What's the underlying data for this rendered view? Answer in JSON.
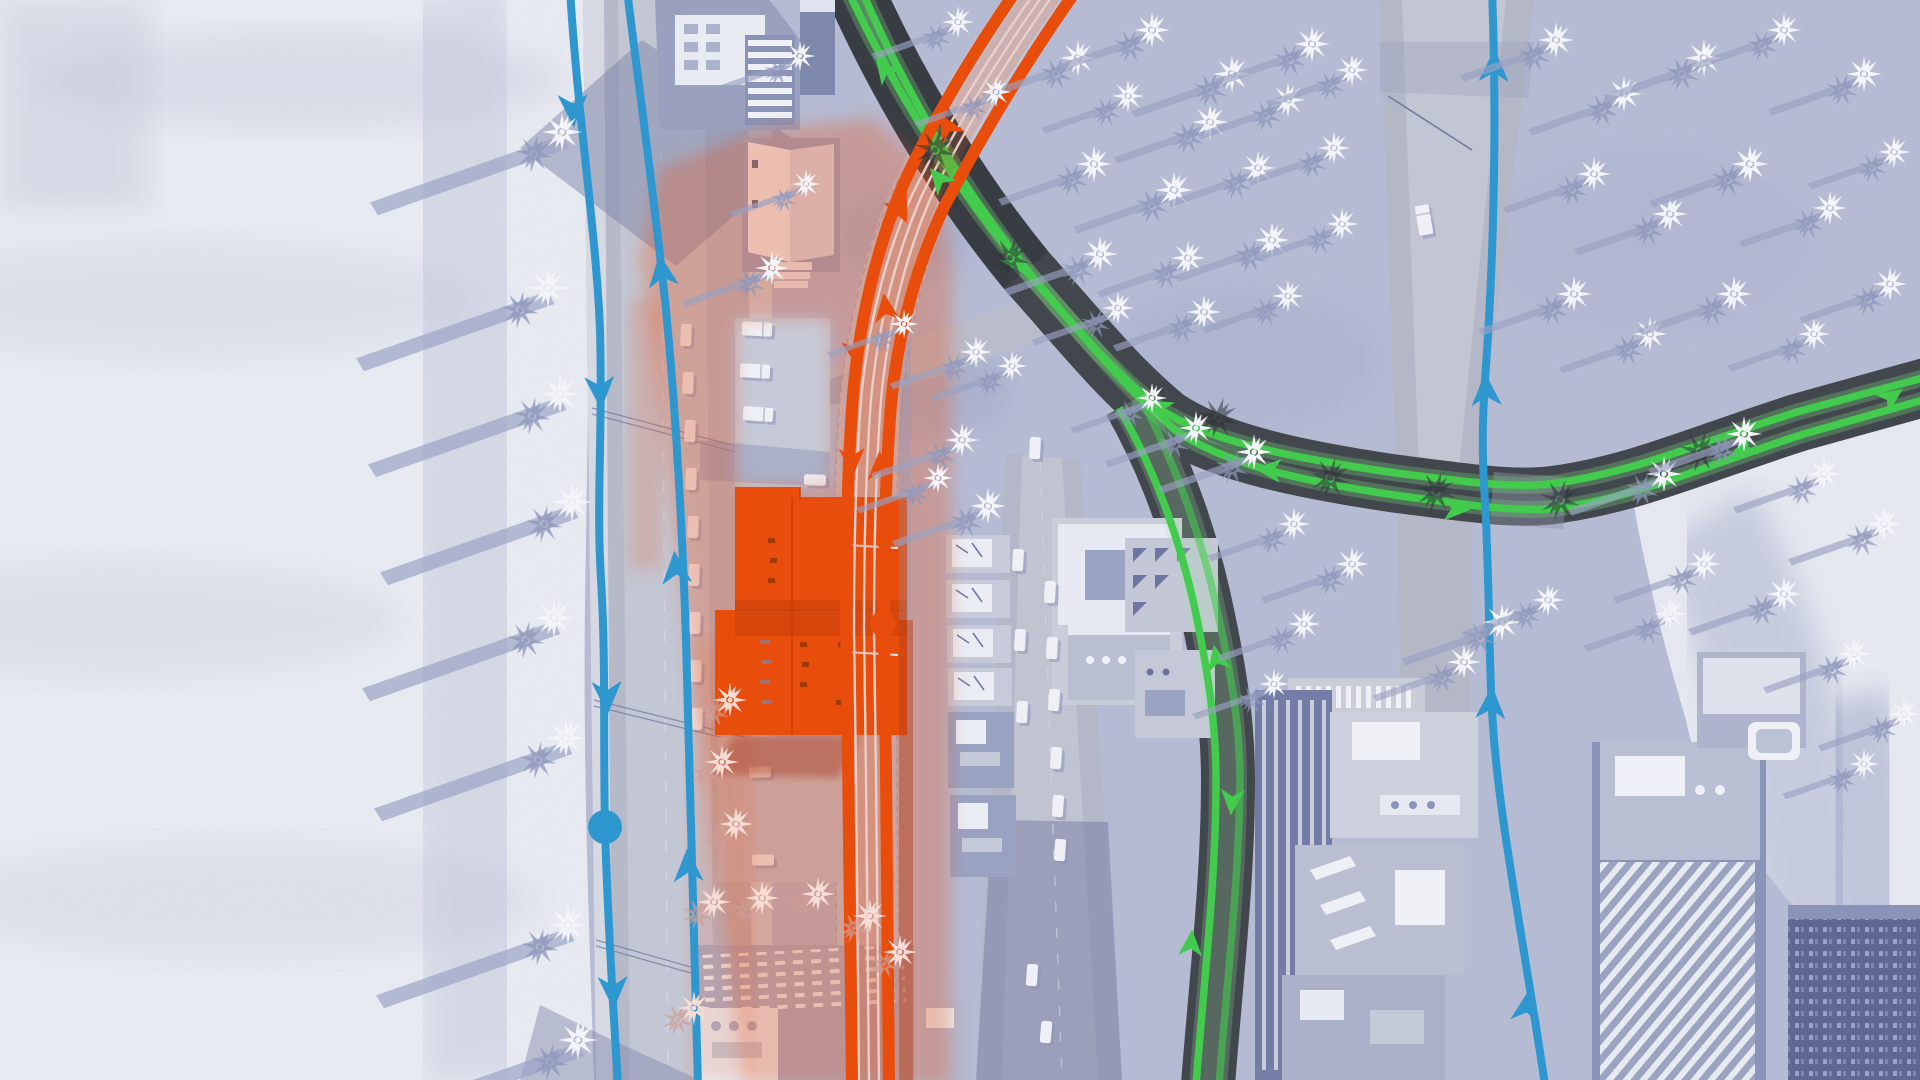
{
  "meta": {
    "app": "city-builder-game",
    "view": "public-transport-lines-overlay",
    "visible_text": "none",
    "canvas": [
      1920,
      1080
    ]
  },
  "palette": {
    "terrain": "#b5bbd3",
    "terrainShade": "#8d96bb",
    "beach": "#e9ebf2",
    "roadLight": "#b6b9c8",
    "roadLane": "#c3c6d3",
    "sidewalk": "#d3d6e1",
    "roadDark": "#42474d",
    "railBand": "#c5c8d5",
    "railWhite": "#e9ebf3",
    "wall": "#99a1bf",
    "wallDark": "#747da6",
    "roof": "#c9cdda",
    "whiteDetail": "#eff1f7",
    "blue": "#2f97d0",
    "green": "#43cb4e",
    "greenHalo": "#7ad77f",
    "orange": "#e84d0c",
    "orangeDeep": "#c2410a",
    "zoneRed": "#e85a28",
    "treeWhite": "#f3f4f8",
    "treeShadow": "#8e97bb",
    "zoneTree": "#f6dcd4",
    "zoneTreeShadow": "#cf9f96",
    "darkBldg": "#5f6890"
  },
  "overlay": {
    "routes": [
      {
        "id": "blue-line-west",
        "color": "#2f97d0",
        "direction": "southbound",
        "arrow_count": 4
      },
      {
        "id": "blue-line-east",
        "color": "#2f97d0",
        "direction": "northbound",
        "arrow_count": 3
      },
      {
        "id": "blue-line-far-east",
        "color": "#2f97d0",
        "direction": "northbound",
        "arrow_count": 4
      },
      {
        "id": "green-line",
        "color": "#43cb4e",
        "direction": "two-way",
        "shape": "curve-with-south-branch"
      },
      {
        "id": "orange-rail-line",
        "color": "#e84d0c",
        "direction": "two-way",
        "follows": "railway"
      }
    ],
    "stops": [
      {
        "id": "blue-stop",
        "x": 605,
        "y": 827,
        "r": 17,
        "color": "#2f97d0"
      },
      {
        "id": "orange-stop",
        "x": 883,
        "y": 624,
        "r": 13,
        "color": "#e84d0c"
      }
    ],
    "selected_building": {
      "id": "selected-rail-depot",
      "x": 735,
      "y": 497,
      "w": 172,
      "h": 238,
      "color": "#e84d0c"
    }
  },
  "scene": {
    "beach_trees": [
      [
        562,
        132
      ],
      [
        548,
        288
      ],
      [
        560,
        394
      ],
      [
        572,
        502
      ],
      [
        554,
        618
      ],
      [
        566,
        738
      ],
      [
        568,
        925
      ],
      [
        578,
        1040
      ]
    ],
    "east_trees": [
      [
        1078,
        58,
        1
      ],
      [
        1152,
        30,
        1
      ],
      [
        1232,
        74,
        1.05
      ],
      [
        1312,
        44,
        1
      ],
      [
        1128,
        96,
        0.9
      ],
      [
        1210,
        122,
        1
      ],
      [
        1288,
        100,
        0.95
      ],
      [
        1352,
        70,
        0.9
      ],
      [
        1094,
        164,
        1
      ],
      [
        1174,
        190,
        1.05
      ],
      [
        1258,
        168,
        0.95
      ],
      [
        1334,
        148,
        0.9
      ],
      [
        1100,
        254,
        1
      ],
      [
        1188,
        258,
        0.95
      ],
      [
        1272,
        240,
        1
      ],
      [
        1342,
        224,
        0.9
      ],
      [
        1118,
        308,
        0.9
      ],
      [
        1204,
        312,
        0.95
      ],
      [
        1288,
        296,
        0.9
      ],
      [
        1556,
        40,
        1
      ],
      [
        1624,
        94,
        1
      ],
      [
        1704,
        58,
        1.05
      ],
      [
        1784,
        30,
        0.95
      ],
      [
        1864,
        74,
        1
      ],
      [
        1594,
        174,
        0.95
      ],
      [
        1670,
        214,
        1
      ],
      [
        1750,
        164,
        1.05
      ],
      [
        1830,
        208,
        0.95
      ],
      [
        1894,
        152,
        0.9
      ],
      [
        1574,
        294,
        1
      ],
      [
        1650,
        334,
        0.95
      ],
      [
        1734,
        294,
        1
      ],
      [
        1814,
        334,
        0.9
      ],
      [
        1890,
        284,
        0.95
      ],
      [
        1196,
        428,
        0.95
      ],
      [
        1254,
        452,
        1
      ],
      [
        1152,
        398,
        0.85
      ],
      [
        1502,
        622,
        1.05
      ],
      [
        1548,
        600,
        0.9
      ],
      [
        1464,
        662,
        0.95
      ],
      [
        1294,
        524,
        0.9
      ],
      [
        1352,
        564,
        0.95
      ],
      [
        1304,
        624,
        0.9
      ],
      [
        1274,
        684,
        0.85
      ],
      [
        1664,
        474,
        1
      ],
      [
        1744,
        434,
        1
      ],
      [
        1824,
        474,
        0.95
      ],
      [
        1884,
        524,
        1
      ],
      [
        1704,
        564,
        0.95
      ],
      [
        1784,
        594,
        1
      ],
      [
        1854,
        654,
        0.95
      ],
      [
        1670,
        614,
        0.9
      ],
      [
        1904,
        714,
        0.9
      ],
      [
        1864,
        764,
        0.85
      ],
      [
        962,
        440,
        0.95
      ],
      [
        988,
        506,
        1
      ],
      [
        938,
        478,
        0.85
      ],
      [
        976,
        352,
        0.9
      ],
      [
        1012,
        366,
        0.85
      ],
      [
        772,
        268,
        0.95
      ],
      [
        806,
        184,
        0.8
      ],
      [
        800,
        56,
        0.85
      ],
      [
        958,
        22,
        0.9
      ],
      [
        996,
        92,
        0.85
      ],
      [
        904,
        324,
        0.8
      ]
    ],
    "zone_trees": [
      [
        730,
        700
      ],
      [
        722,
        762
      ],
      [
        736,
        824
      ],
      [
        714,
        902
      ],
      [
        762,
        898
      ],
      [
        818,
        894
      ],
      [
        870,
        916
      ],
      [
        900,
        952
      ],
      [
        694,
        1008
      ]
    ],
    "dark_palms": [
      [
        1218,
        418
      ],
      [
        1330,
        478
      ],
      [
        1436,
        492
      ],
      [
        1700,
        452
      ],
      [
        935,
        150
      ],
      [
        1010,
        258
      ],
      [
        1560,
        500
      ]
    ],
    "blue_arrows": [
      [
        573,
        108,
        178
      ],
      [
        600,
        390,
        177
      ],
      [
        607,
        695,
        178
      ],
      [
        613,
        990,
        178
      ],
      [
        662,
        273,
        -8
      ],
      [
        676,
        570,
        -5
      ],
      [
        688,
        868,
        -3
      ],
      [
        1494,
        68,
        2
      ],
      [
        1486,
        392,
        -3
      ],
      [
        1491,
        705,
        3
      ],
      [
        1527,
        1008,
        8
      ]
    ],
    "green_arrows": [
      [
        885,
        70,
        -37
      ],
      [
        1016,
        262,
        143
      ],
      [
        1160,
        408,
        -62
      ],
      [
        1270,
        470,
        -85
      ],
      [
        1455,
        509,
        93
      ],
      [
        1890,
        398,
        55
      ],
      [
        1745,
        448,
        -115
      ],
      [
        1217,
        660,
        -12
      ],
      [
        1191,
        945,
        4
      ],
      [
        1232,
        800,
        184
      ],
      [
        940,
        180,
        -40
      ]
    ],
    "orange_arrows": [
      [
        900,
        208,
        155
      ],
      [
        856,
        352,
        172
      ],
      [
        948,
        128,
        -30
      ],
      [
        886,
        310,
        -8
      ],
      [
        852,
        460,
        178
      ],
      [
        880,
        468,
        -2
      ]
    ],
    "vehicles": [
      {
        "t": "car",
        "x": 686,
        "y": 335,
        "r": 2
      },
      {
        "t": "car",
        "x": 688,
        "y": 383,
        "r": 2
      },
      {
        "t": "car",
        "x": 690,
        "y": 431,
        "r": 2
      },
      {
        "t": "car",
        "x": 691,
        "y": 479,
        "r": 2
      },
      {
        "t": "car",
        "x": 693,
        "y": 527,
        "r": 2
      },
      {
        "t": "car",
        "x": 694,
        "y": 575,
        "r": 2
      },
      {
        "t": "car",
        "x": 695,
        "y": 623,
        "r": 2
      },
      {
        "t": "car",
        "x": 696,
        "y": 671,
        "r": 2
      },
      {
        "t": "car",
        "x": 697,
        "y": 719,
        "r": 2
      },
      {
        "t": "car",
        "x": 1018,
        "y": 560,
        "r": 3
      },
      {
        "t": "car",
        "x": 1020,
        "y": 640,
        "r": 3
      },
      {
        "t": "car",
        "x": 1022,
        "y": 712,
        "r": 3
      },
      {
        "t": "car",
        "x": 1050,
        "y": 592,
        "r": 3
      },
      {
        "t": "car",
        "x": 1052,
        "y": 648,
        "r": 3
      },
      {
        "t": "car",
        "x": 1054,
        "y": 700,
        "r": 4
      },
      {
        "t": "car",
        "x": 1056,
        "y": 758,
        "r": 4
      },
      {
        "t": "car",
        "x": 1058,
        "y": 806,
        "r": 4
      },
      {
        "t": "car",
        "x": 1060,
        "y": 850,
        "r": 4
      },
      {
        "t": "car",
        "x": 1035,
        "y": 448,
        "r": 3
      },
      {
        "t": "car",
        "x": 1032,
        "y": 975,
        "r": 4
      },
      {
        "t": "car",
        "x": 1046,
        "y": 1032,
        "r": 5
      },
      {
        "t": "truck",
        "x": 757,
        "y": 329,
        "r": 93
      },
      {
        "t": "truck",
        "x": 755,
        "y": 371,
        "r": 93
      },
      {
        "t": "truck",
        "x": 758,
        "y": 414,
        "r": 94
      },
      {
        "t": "car",
        "x": 815,
        "y": 480,
        "r": 92
      },
      {
        "t": "car",
        "x": 760,
        "y": 772,
        "r": 88
      },
      {
        "t": "car",
        "x": 763,
        "y": 860,
        "r": 90
      },
      {
        "t": "truck",
        "x": 1424,
        "y": 220,
        "r": -10
      }
    ]
  }
}
